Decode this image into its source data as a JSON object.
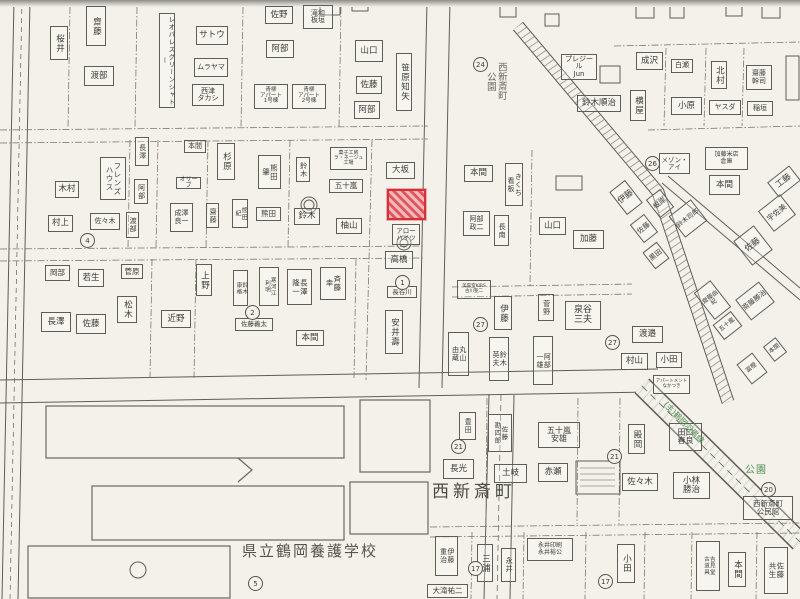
{
  "map": {
    "paper": "#f3f1ea",
    "ink": "#55534d",
    "highlight": {
      "x": 387,
      "y": 189,
      "w": 39,
      "h": 31,
      "stroke": "#d92f38",
      "fill": "#f2b8bc"
    },
    "area_labels": [
      {
        "t": "西新斎町\n公園",
        "x": 484,
        "y": 62,
        "fs": 9.5,
        "v": 1,
        "color": "#6b6963"
      },
      {
        "t": "西新斎町",
        "x": 432,
        "y": 483,
        "fs": 17,
        "ls": 4,
        "color": "#4a4842"
      },
      {
        "t": "県立鶴岡養護学校",
        "x": 242,
        "y": 543,
        "fs": 15,
        "ls": 2,
        "color": "#56544e"
      },
      {
        "t": "公園",
        "x": 745,
        "y": 465,
        "fs": 10,
        "ls": 1,
        "color": "#4f8f55"
      },
      {
        "t": "(主)鶴岡羽黒線",
        "x": 668,
        "y": 400,
        "fs": 8,
        "r": 46,
        "color": "#4f8f55"
      }
    ],
    "labels": [
      {
        "t": "齋藤",
        "x": 86,
        "y": 6,
        "w": 20,
        "h": 40,
        "v": 1
      },
      {
        "t": "桜井",
        "x": 50,
        "y": 26,
        "w": 18,
        "h": 34,
        "v": 1
      },
      {
        "t": "渡部",
        "x": 84,
        "y": 66,
        "w": 30,
        "h": 20
      },
      {
        "t": "レオパレスグリーンシャトー",
        "x": 159,
        "y": 13,
        "w": 16,
        "h": 95,
        "v": 1,
        "fs": 6.5
      },
      {
        "t": "サトウ",
        "x": 196,
        "y": 26,
        "w": 32,
        "h": 19
      },
      {
        "t": "ムラヤマ",
        "x": 194,
        "y": 58,
        "w": 34,
        "h": 19,
        "fs": 7
      },
      {
        "t": "西津\nタカシ",
        "x": 192,
        "y": 84,
        "w": 32,
        "h": 22,
        "fs": 7
      },
      {
        "t": "佐野",
        "x": 265,
        "y": 6,
        "w": 28,
        "h": 18
      },
      {
        "t": "滝和\n板垣",
        "x": 303,
        "y": 5,
        "w": 30,
        "h": 24,
        "fs": 7
      },
      {
        "t": "阿部",
        "x": 266,
        "y": 40,
        "w": 28,
        "h": 18
      },
      {
        "t": "青柳\nアパート\n1号棟",
        "x": 254,
        "y": 84,
        "w": 34,
        "h": 25,
        "fs": 5.5
      },
      {
        "t": "青柳\nアパート\n2号棟",
        "x": 292,
        "y": 84,
        "w": 34,
        "h": 25,
        "fs": 5.5
      },
      {
        "t": "山口",
        "x": 355,
        "y": 40,
        "w": 28,
        "h": 22
      },
      {
        "t": "佐藤",
        "x": 356,
        "y": 76,
        "w": 26,
        "h": 18
      },
      {
        "t": "阿部",
        "x": 354,
        "y": 101,
        "w": 26,
        "h": 18
      },
      {
        "t": "笹原知矢",
        "x": 396,
        "y": 53,
        "w": 16,
        "h": 58,
        "v": 1
      },
      {
        "t": "プレジール\nJun",
        "x": 561,
        "y": 54,
        "w": 36,
        "h": 26,
        "fs": 7
      },
      {
        "t": "鈴木順治",
        "x": 577,
        "y": 95,
        "w": 44,
        "h": 17
      },
      {
        "t": "成沢",
        "x": 636,
        "y": 52,
        "w": 27,
        "h": 18
      },
      {
        "t": "白瀬",
        "x": 671,
        "y": 59,
        "w": 22,
        "h": 14,
        "fs": 7
      },
      {
        "t": "北村",
        "x": 711,
        "y": 61,
        "w": 16,
        "h": 28,
        "v": 1
      },
      {
        "t": "齋藤\n幹司",
        "x": 746,
        "y": 65,
        "w": 26,
        "h": 25,
        "fs": 7
      },
      {
        "t": "横屋",
        "x": 630,
        "y": 90,
        "w": 16,
        "h": 31,
        "v": 1
      },
      {
        "t": "小原",
        "x": 671,
        "y": 97,
        "w": 31,
        "h": 18
      },
      {
        "t": "ヤスダ",
        "x": 709,
        "y": 100,
        "w": 32,
        "h": 15,
        "fs": 7
      },
      {
        "t": "稲垣",
        "x": 747,
        "y": 101,
        "w": 26,
        "h": 15,
        "fs": 7
      },
      {
        "t": "長澤",
        "x": 135,
        "y": 137,
        "w": 14,
        "h": 29,
        "v": 1,
        "fs": 7
      },
      {
        "t": "阿部",
        "x": 134,
        "y": 179,
        "w": 14,
        "h": 25,
        "v": 1,
        "fs": 7
      },
      {
        "t": "渡部",
        "x": 126,
        "y": 212,
        "w": 13,
        "h": 26,
        "v": 1,
        "fs": 7
      },
      {
        "t": "フレンズ\nハウス",
        "x": 100,
        "y": 157,
        "w": 26,
        "h": 43,
        "v": 1,
        "fs": 7.5
      },
      {
        "t": "木村",
        "x": 55,
        "y": 181,
        "w": 24,
        "h": 17
      },
      {
        "t": "村上",
        "x": 48,
        "y": 215,
        "w": 25,
        "h": 17
      },
      {
        "t": "佐々木",
        "x": 90,
        "y": 213,
        "w": 30,
        "h": 17,
        "fs": 7
      },
      {
        "t": "本間",
        "x": 184,
        "y": 140,
        "w": 22,
        "h": 13,
        "fs": 7
      },
      {
        "t": "オリーブ",
        "x": 176,
        "y": 177,
        "w": 25,
        "h": 12,
        "fs": 6
      },
      {
        "t": "成澤\n良一",
        "x": 170,
        "y": 203,
        "w": 23,
        "h": 29,
        "fs": 7
      },
      {
        "t": "杉原",
        "x": 217,
        "y": 143,
        "w": 18,
        "h": 37,
        "v": 1
      },
      {
        "t": "熊田\n肇",
        "x": 258,
        "y": 155,
        "w": 23,
        "h": 34,
        "v": 1,
        "fs": 7.5
      },
      {
        "t": "鈴木",
        "x": 296,
        "y": 157,
        "w": 14,
        "h": 25,
        "v": 1,
        "fs": 7
      },
      {
        "t": "五十嵐",
        "x": 329,
        "y": 179,
        "w": 34,
        "h": 14,
        "fs": 7.5
      },
      {
        "t": "菓子工房\nラ・ネージュ\n工場",
        "x": 330,
        "y": 147,
        "w": 37,
        "h": 23,
        "fs": 5
      },
      {
        "t": "齋藤",
        "x": 206,
        "y": 203,
        "w": 13,
        "h": 25,
        "v": 1,
        "fs": 7
      },
      {
        "t": "熊田\n紀",
        "x": 232,
        "y": 199,
        "w": 16,
        "h": 29,
        "v": 1,
        "fs": 6
      },
      {
        "t": "熊田",
        "x": 256,
        "y": 207,
        "w": 25,
        "h": 14,
        "fs": 7.5
      },
      {
        "t": "鈴木",
        "x": 294,
        "y": 208,
        "w": 26,
        "h": 17
      },
      {
        "t": "柚山",
        "x": 336,
        "y": 218,
        "w": 26,
        "h": 16
      },
      {
        "t": "大坂",
        "x": 386,
        "y": 162,
        "w": 29,
        "h": 17
      },
      {
        "t": "アロー\nハイツ",
        "x": 392,
        "y": 224,
        "w": 28,
        "h": 21,
        "fs": 6.5
      },
      {
        "t": "高橋",
        "x": 385,
        "y": 251,
        "w": 28,
        "h": 18
      },
      {
        "t": "長谷川",
        "x": 387,
        "y": 286,
        "w": 30,
        "h": 12,
        "fs": 6.5
      },
      {
        "t": "安井壽",
        "x": 385,
        "y": 310,
        "w": 18,
        "h": 44,
        "v": 1
      },
      {
        "t": "本間",
        "x": 464,
        "y": 165,
        "w": 29,
        "h": 17
      },
      {
        "t": "きくち\n看板",
        "x": 505,
        "y": 163,
        "w": 18,
        "h": 43,
        "v": 1,
        "fs": 7
      },
      {
        "t": "阿部\n政二",
        "x": 463,
        "y": 211,
        "w": 27,
        "h": 25,
        "fs": 7
      },
      {
        "t": "長南",
        "x": 494,
        "y": 215,
        "w": 15,
        "h": 31,
        "v": 1,
        "fs": 7
      },
      {
        "t": "山口",
        "x": 539,
        "y": 217,
        "w": 27,
        "h": 18
      },
      {
        "t": "加藤",
        "x": 573,
        "y": 230,
        "w": 31,
        "h": 19
      },
      {
        "t": "メゾン・\nアイ",
        "x": 659,
        "y": 153,
        "w": 31,
        "h": 21,
        "fs": 6.5
      },
      {
        "t": "伊藤",
        "x": 616,
        "y": 183,
        "w": 20,
        "h": 29,
        "r": -38
      },
      {
        "t": "根岸",
        "x": 651,
        "y": 192,
        "w": 18,
        "h": 23,
        "r": -38,
        "fs": 7
      },
      {
        "t": "鈴木司郎",
        "x": 674,
        "y": 205,
        "w": 28,
        "h": 27,
        "r": -38,
        "fs": 6.5
      },
      {
        "t": "佐藤",
        "x": 635,
        "y": 217,
        "w": 18,
        "h": 23,
        "r": -38,
        "fs": 7
      },
      {
        "t": "黒田",
        "x": 647,
        "y": 245,
        "w": 18,
        "h": 21,
        "r": -38,
        "fs": 7
      },
      {
        "t": "加藤米店\n倉庫",
        "x": 705,
        "y": 147,
        "w": 43,
        "h": 23,
        "fs": 6
      },
      {
        "t": "本間",
        "x": 709,
        "y": 175,
        "w": 31,
        "h": 20
      },
      {
        "t": "工藤",
        "x": 770,
        "y": 172,
        "w": 28,
        "h": 19,
        "r": -38
      },
      {
        "t": "宇佐美",
        "x": 763,
        "y": 200,
        "w": 28,
        "h": 26,
        "r": -38,
        "fs": 7.5
      },
      {
        "t": "佐藤",
        "x": 740,
        "y": 230,
        "w": 26,
        "h": 31,
        "r": -38
      },
      {
        "t": "齋藤由紀",
        "x": 702,
        "y": 283,
        "w": 21,
        "h": 34,
        "r": -38,
        "fs": 6
      },
      {
        "t": "斎藤勝治",
        "x": 740,
        "y": 288,
        "w": 30,
        "h": 26,
        "r": -38,
        "fs": 7
      },
      {
        "t": "五十嵐",
        "x": 716,
        "y": 316,
        "w": 23,
        "h": 19,
        "r": -38,
        "fs": 6
      },
      {
        "t": "本間",
        "x": 767,
        "y": 340,
        "w": 16,
        "h": 19,
        "r": -38,
        "fs": 6
      },
      {
        "t": "冨樫",
        "x": 742,
        "y": 356,
        "w": 20,
        "h": 25,
        "r": -38,
        "fs": 6
      },
      {
        "t": "岡部",
        "x": 45,
        "y": 265,
        "w": 25,
        "h": 16,
        "fs": 7.5
      },
      {
        "t": "若生",
        "x": 78,
        "y": 269,
        "w": 26,
        "h": 18
      },
      {
        "t": "菅原",
        "x": 121,
        "y": 264,
        "w": 22,
        "h": 15,
        "fs": 7.5
      },
      {
        "t": "長澤",
        "x": 41,
        "y": 312,
        "w": 30,
        "h": 20
      },
      {
        "t": "佐藤",
        "x": 76,
        "y": 314,
        "w": 30,
        "h": 20
      },
      {
        "t": "松木",
        "x": 117,
        "y": 296,
        "w": 20,
        "h": 27,
        "v": 1
      },
      {
        "t": "近野",
        "x": 161,
        "y": 310,
        "w": 30,
        "h": 18
      },
      {
        "t": "上野",
        "x": 196,
        "y": 264,
        "w": 16,
        "h": 32,
        "v": 1
      },
      {
        "t": "鈴木\n康格",
        "x": 233,
        "y": 270,
        "w": 15,
        "h": 36,
        "v": 1,
        "fs": 5.5
      },
      {
        "t": "寒河江\n利明",
        "x": 259,
        "y": 267,
        "w": 20,
        "h": 39,
        "v": 1,
        "fs": 5.5
      },
      {
        "t": "長澤\n隆一",
        "x": 287,
        "y": 269,
        "w": 25,
        "h": 36,
        "v": 1,
        "fs": 7.5
      },
      {
        "t": "斉藤\n幸",
        "x": 320,
        "y": 267,
        "w": 26,
        "h": 33,
        "v": 1,
        "fs": 7.5
      },
      {
        "t": "佐藤義太",
        "x": 235,
        "y": 318,
        "w": 38,
        "h": 13,
        "fs": 6.5
      },
      {
        "t": "本間",
        "x": 296,
        "y": 330,
        "w": 28,
        "h": 16
      },
      {
        "t": "美容室KIRS\n古川聖二",
        "x": 457,
        "y": 280,
        "w": 34,
        "h": 19,
        "fs": 4.5
      },
      {
        "t": "伊藤",
        "x": 494,
        "y": 296,
        "w": 18,
        "h": 34,
        "v": 1
      },
      {
        "t": "菅野",
        "x": 538,
        "y": 294,
        "w": 16,
        "h": 27,
        "v": 1,
        "fs": 7
      },
      {
        "t": "泉谷\n三夫",
        "x": 565,
        "y": 301,
        "w": 36,
        "h": 29,
        "fs": 9
      },
      {
        "t": "丸山\n由蔵",
        "x": 448,
        "y": 332,
        "w": 21,
        "h": 44,
        "v": 1,
        "fs": 7
      },
      {
        "t": "鈴木\n英夫",
        "x": 489,
        "y": 337,
        "w": 20,
        "h": 44,
        "v": 1,
        "fs": 7
      },
      {
        "t": "阿部\n一雄",
        "x": 533,
        "y": 336,
        "w": 20,
        "h": 49,
        "v": 1,
        "fs": 7
      },
      {
        "t": "渡邉",
        "x": 632,
        "y": 326,
        "w": 31,
        "h": 17
      },
      {
        "t": "村山",
        "x": 621,
        "y": 353,
        "w": 27,
        "h": 17
      },
      {
        "t": "小田",
        "x": 656,
        "y": 352,
        "w": 26,
        "h": 16
      },
      {
        "t": "アパートメント\nなかつき",
        "x": 653,
        "y": 375,
        "w": 37,
        "h": 19,
        "fs": 4.5
      },
      {
        "t": "殿岡",
        "x": 628,
        "y": 424,
        "w": 17,
        "h": 30,
        "v": 1
      },
      {
        "t": "田口\n春良",
        "x": 669,
        "y": 423,
        "w": 33,
        "h": 28,
        "fs": 8
      },
      {
        "t": "佐々木",
        "x": 622,
        "y": 473,
        "w": 36,
        "h": 18
      },
      {
        "t": "小林\n勝治",
        "x": 673,
        "y": 472,
        "w": 37,
        "h": 27,
        "fs": 8.5
      },
      {
        "t": "西新斎町\n公民館",
        "x": 743,
        "y": 496,
        "w": 50,
        "h": 24,
        "fs": 7.5
      },
      {
        "t": "豊田",
        "x": 459,
        "y": 412,
        "w": 17,
        "h": 28,
        "v": 1,
        "fs": 7
      },
      {
        "t": "佐藤\n勘四郎",
        "x": 488,
        "y": 414,
        "w": 24,
        "h": 38,
        "v": 1,
        "fs": 6.5
      },
      {
        "t": "五十嵐\n安雄",
        "x": 538,
        "y": 422,
        "w": 42,
        "h": 26,
        "fs": 8
      },
      {
        "t": "長光",
        "x": 443,
        "y": 459,
        "w": 31,
        "h": 20
      },
      {
        "t": "土岐",
        "x": 494,
        "y": 464,
        "w": 33,
        "h": 19
      },
      {
        "t": "赤瀬",
        "x": 538,
        "y": 463,
        "w": 30,
        "h": 19
      },
      {
        "t": "伊藤\n重治",
        "x": 435,
        "y": 536,
        "w": 23,
        "h": 40,
        "v": 1,
        "fs": 7
      },
      {
        "t": "大滝祐二",
        "x": 427,
        "y": 584,
        "w": 41,
        "h": 14,
        "fs": 7.5
      },
      {
        "t": "三浦",
        "x": 477,
        "y": 544,
        "w": 16,
        "h": 38,
        "v": 1
      },
      {
        "t": "永井",
        "x": 501,
        "y": 548,
        "w": 15,
        "h": 34,
        "v": 1,
        "fs": 7
      },
      {
        "t": "永井印刷\n永井裕公",
        "x": 527,
        "y": 538,
        "w": 46,
        "h": 23,
        "fs": 6
      },
      {
        "t": "小田",
        "x": 617,
        "y": 544,
        "w": 18,
        "h": 39,
        "v": 1
      },
      {
        "t": "吉見堂\n古道具",
        "x": 696,
        "y": 541,
        "w": 24,
        "h": 50,
        "v": 1,
        "fs": 5.5
      },
      {
        "t": "本間",
        "x": 728,
        "y": 552,
        "w": 18,
        "h": 35,
        "v": 1
      },
      {
        "t": "佐藤\n共生",
        "x": 764,
        "y": 547,
        "w": 24,
        "h": 47,
        "v": 1,
        "fs": 7.5
      }
    ],
    "circles": [
      {
        "n": "24",
        "x": 473,
        "y": 57
      },
      {
        "n": "26",
        "x": 645,
        "y": 156
      },
      {
        "n": "4",
        "x": 80,
        "y": 233
      },
      {
        "n": "1",
        "x": 395,
        "y": 275
      },
      {
        "n": "2",
        "x": 245,
        "y": 305
      },
      {
        "n": "27",
        "x": 473,
        "y": 317
      },
      {
        "n": "27",
        "x": 605,
        "y": 335
      },
      {
        "n": "21",
        "x": 451,
        "y": 439
      },
      {
        "n": "21",
        "x": 607,
        "y": 449
      },
      {
        "n": "20",
        "x": 761,
        "y": 482
      },
      {
        "n": "17",
        "x": 468,
        "y": 561
      },
      {
        "n": "17",
        "x": 598,
        "y": 574
      },
      {
        "n": "5",
        "x": 248,
        "y": 576
      }
    ]
  }
}
